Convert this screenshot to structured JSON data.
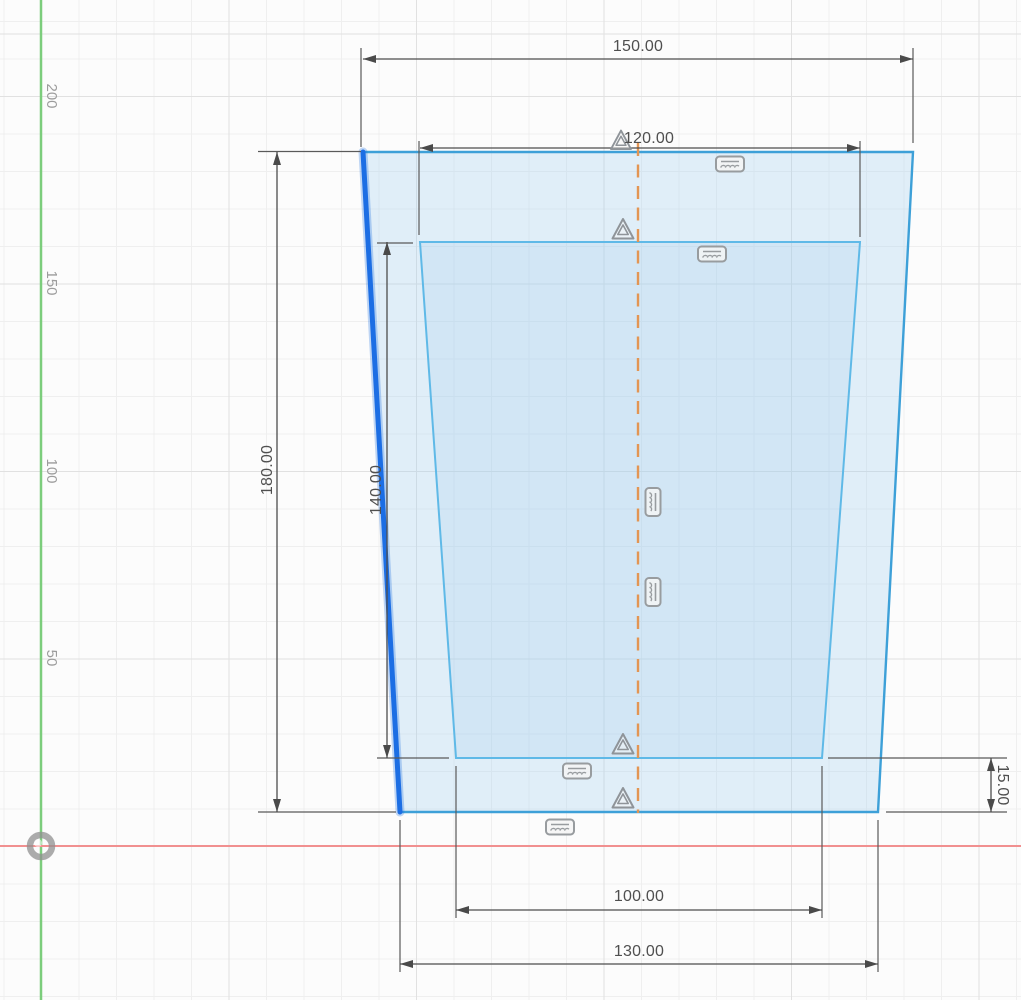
{
  "app": {
    "view_name": "cad-sketch-canvas"
  },
  "ruler": {
    "labels": [
      "200",
      "150",
      "100",
      "50"
    ]
  },
  "dimensions": {
    "outer_top_width": "150.00",
    "inner_top_width": "120.00",
    "outer_height": "180.00",
    "inner_height": "140.00",
    "base_thickness": "15.00",
    "inner_bottom_width": "100.00",
    "outer_bottom_width": "130.00"
  },
  "icons": {
    "symmetry_constraint": "triangle-outline",
    "collinear_constraint": "hatched-bar",
    "origin_point": "gray-ring"
  },
  "constraints": {
    "symmetry_icon_count": 4,
    "collinear_icon_count": 6
  },
  "colors": {
    "selected_line": "#1c6ee4",
    "selected_glow": "rgba(30,110,224,0.28)",
    "sketch_line": "#3da0d8",
    "sketch_line_inner": "#5fb9e7",
    "shape_fill": "rgba(158,206,237,0.30)",
    "shape_fill_inner": "rgba(158,206,237,0.22)",
    "centerline": "#e39553",
    "axis_vertical": "#7ccd7c",
    "axis_horizontal": "#f19090",
    "dimension": "#4d4d4d",
    "grid_major": "#e1e1e1",
    "grid_minor": "#efefef"
  }
}
